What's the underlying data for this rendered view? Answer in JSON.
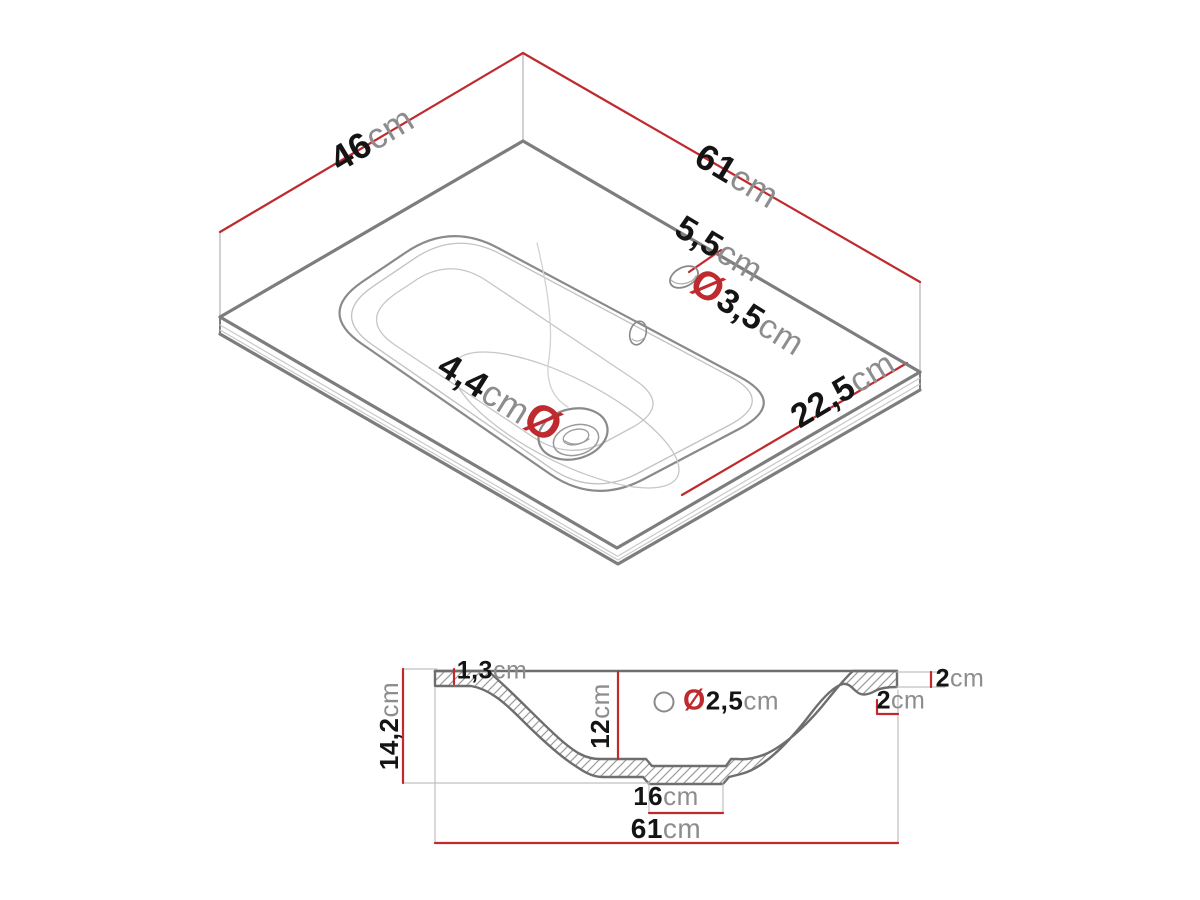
{
  "figure": {
    "type": "technical-drawing",
    "subject": "washbasin dimension diagram",
    "colors": {
      "dimension_red": "#bf2a2e",
      "number_black": "#141414",
      "unit_gray": "#8d8d8d",
      "edge_gray": "#7d7d7d"
    },
    "views": {
      "isometric": {
        "depth": {
          "value": "46",
          "unit": "cm"
        },
        "width": {
          "value": "61",
          "unit": "cm"
        },
        "tap_hole_offset": {
          "value": "5,5",
          "unit": "cm"
        },
        "tap_hole_diameter": {
          "prefix": "Ø",
          "value": "3,5",
          "unit": "cm"
        },
        "front_edge": {
          "value": "22,5",
          "unit": "cm"
        },
        "drain_diameter": {
          "value": "4,4",
          "unit": "cm",
          "suffix": "Ø"
        }
      },
      "section": {
        "rim_thickness": {
          "value": "1,3",
          "unit": "cm"
        },
        "total_height": {
          "value": "14,2",
          "unit": "cm"
        },
        "bowl_depth": {
          "value": "12",
          "unit": "cm"
        },
        "overflow_diameter": {
          "prefix": "Ø",
          "value": "2,5",
          "unit": "cm"
        },
        "right_edge_top": {
          "value": "2",
          "unit": "cm"
        },
        "right_edge_side": {
          "value": "2",
          "unit": "cm"
        },
        "base_width": {
          "value": "16",
          "unit": "cm"
        },
        "total_width": {
          "value": "61",
          "unit": "cm"
        }
      }
    }
  }
}
